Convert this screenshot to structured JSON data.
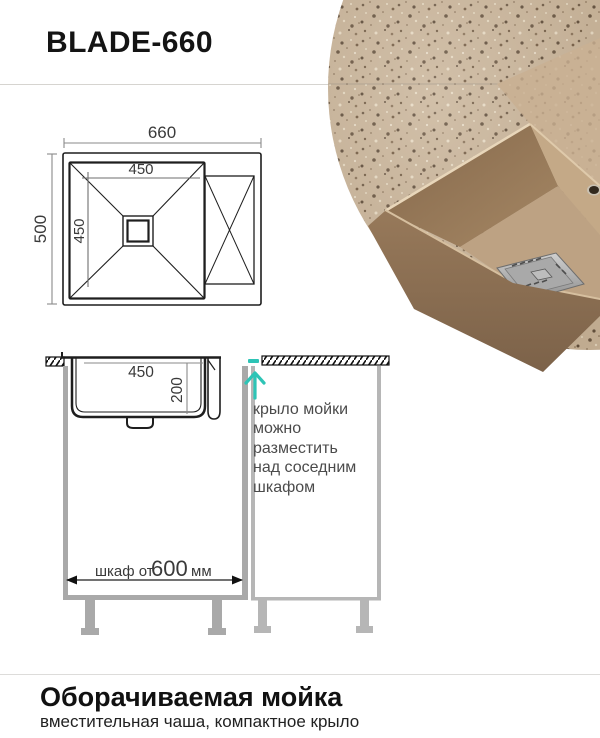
{
  "header": {
    "title": "BLADE-660"
  },
  "photo": {
    "granite_color": "#c9b499",
    "bowl_inner_dark": "#8a6e51",
    "bowl_inner_light": "#c9ae8c",
    "bowl_outer_color": "#8a7054",
    "drain_color": "#9a9a9a"
  },
  "top_view": {
    "overall_width_mm": "660",
    "overall_depth_mm": "500",
    "bowl_width_mm": "450",
    "bowl_depth_mm": "450"
  },
  "side_view": {
    "bowl_width_mm": "450",
    "bowl_depth_mm": "200",
    "cabinet_dim_prefix": "шкаф от",
    "cabinet_dim_value": "600",
    "cabinet_dim_unit": "мм",
    "annotation": "крыло мойки\nможно\nразместить\nнад соседним\nшкафом",
    "accent_color": "#2ec4b6"
  },
  "footer": {
    "title": "Оборачиваемая мойка",
    "subtitle": "вместительная чаша, компактное крыло"
  }
}
